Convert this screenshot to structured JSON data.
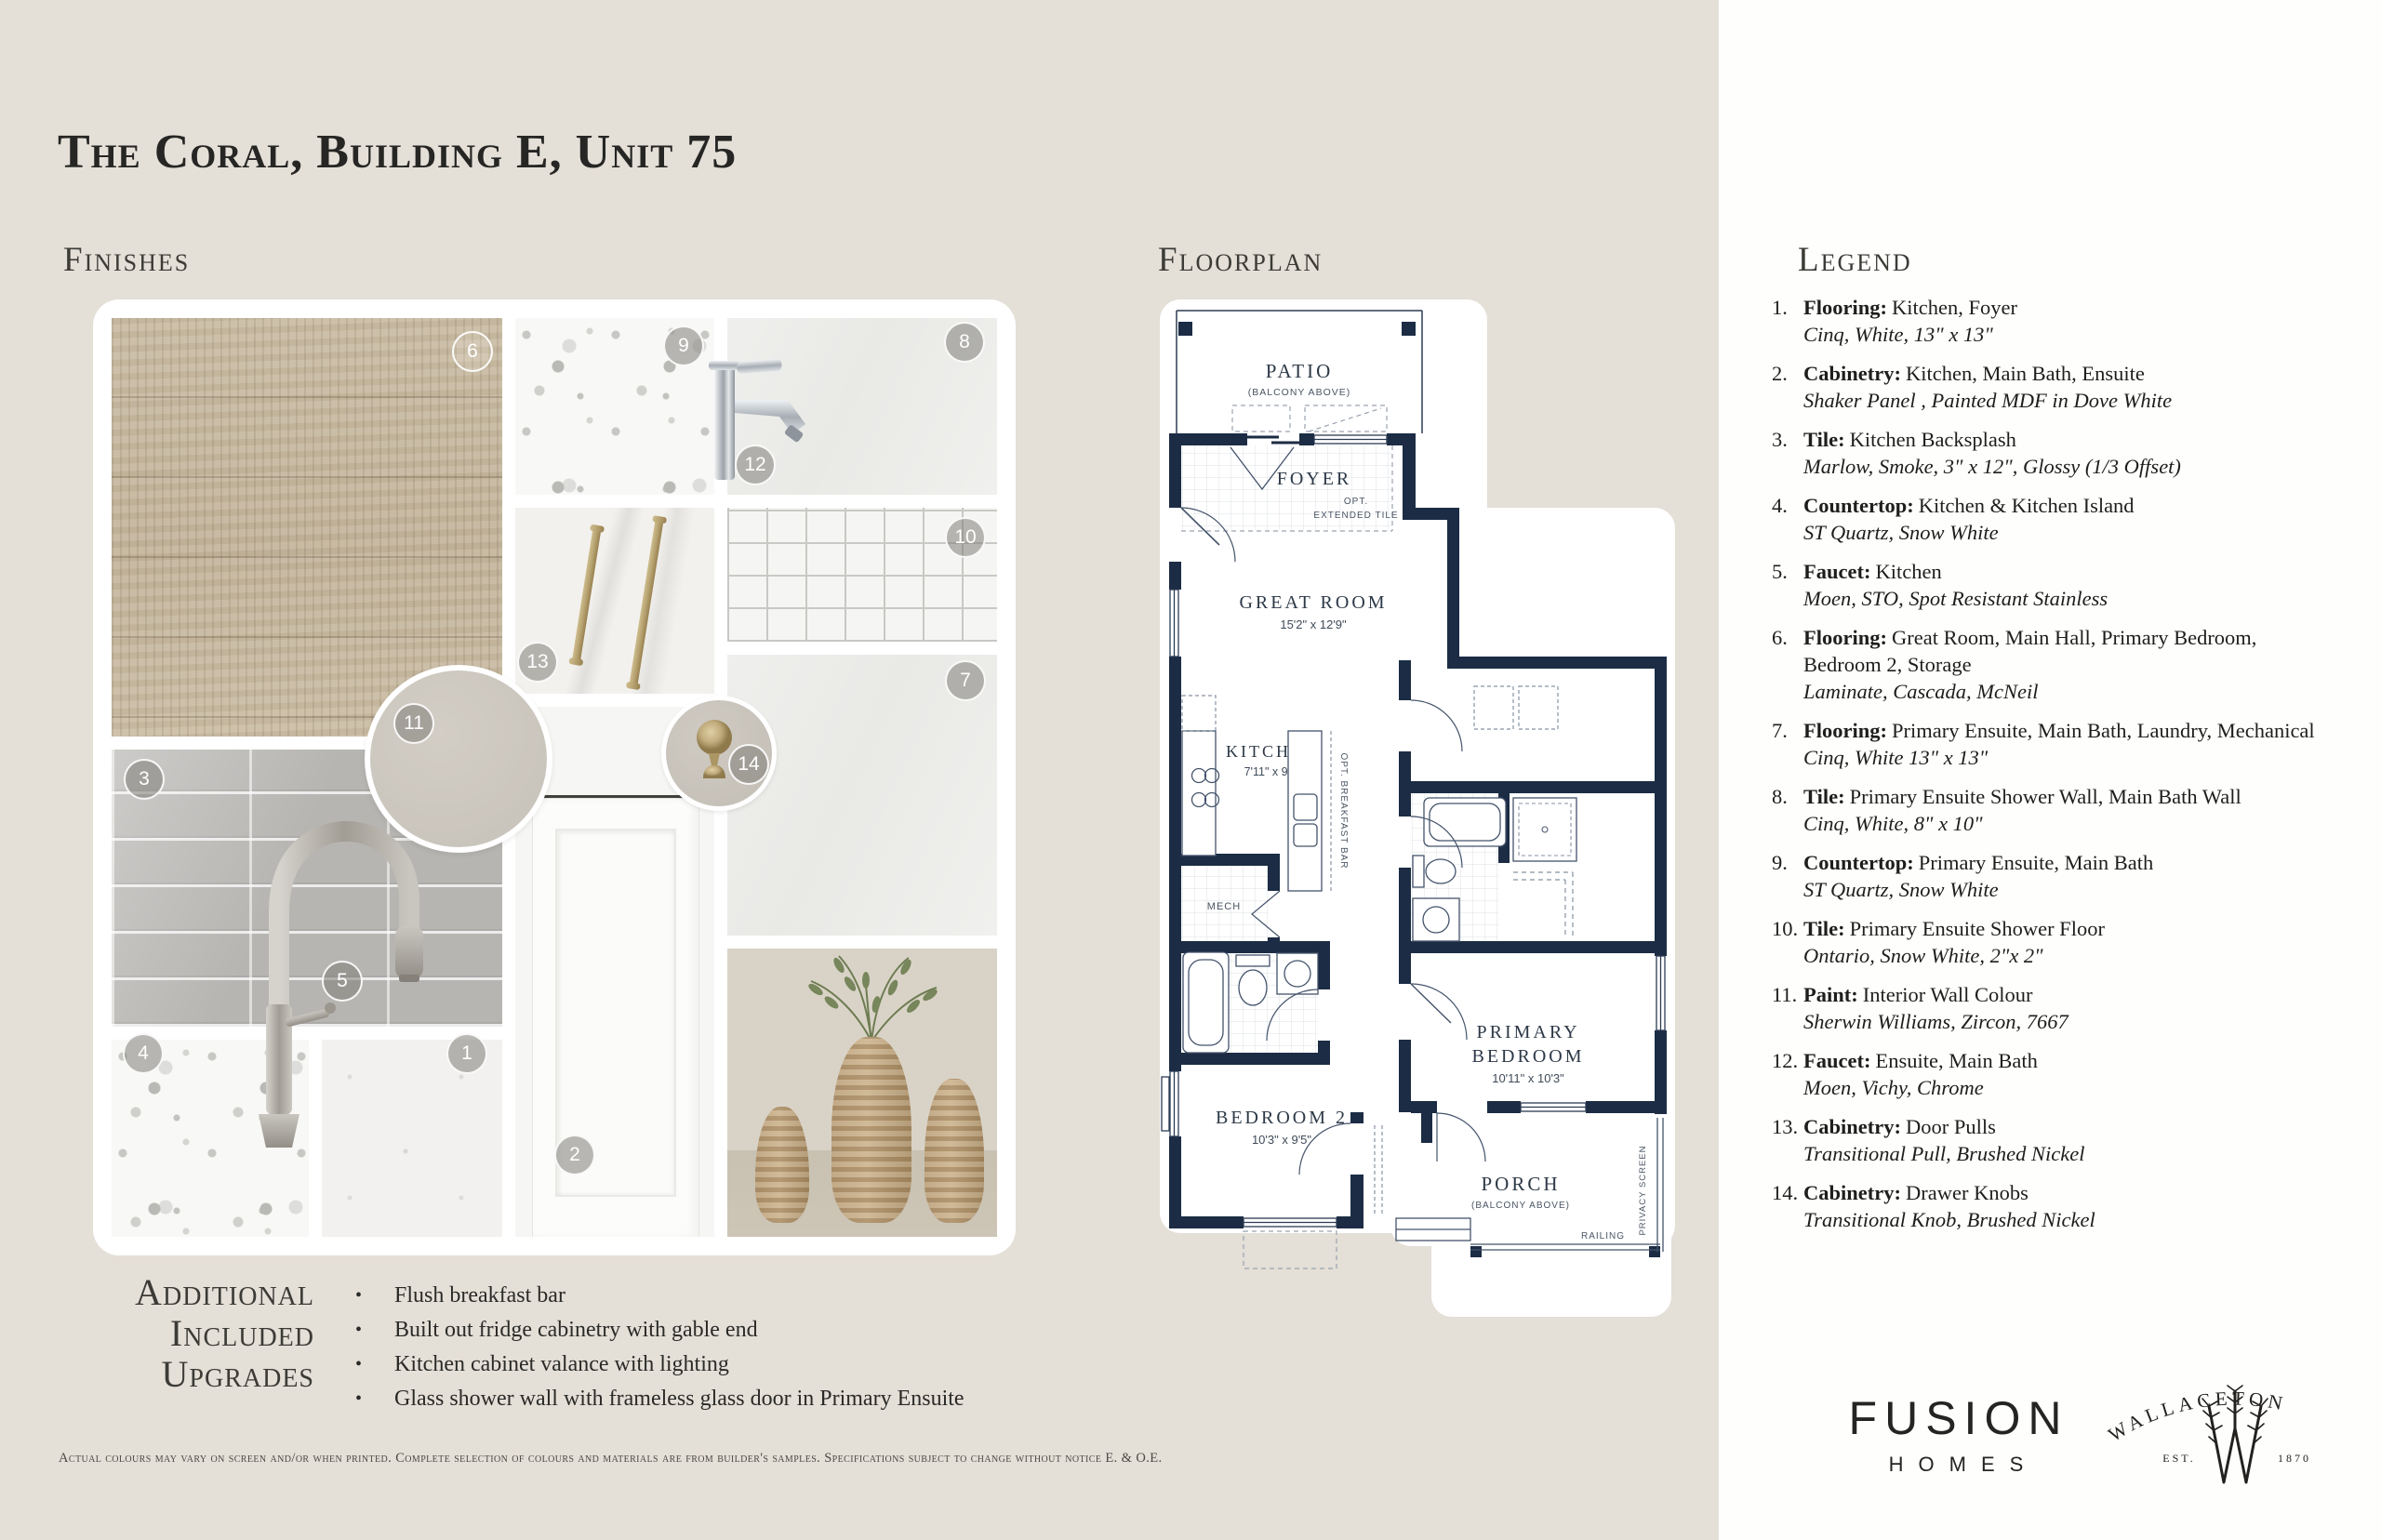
{
  "page": {
    "title": "The Coral, Building E, Unit 75"
  },
  "headings": {
    "finishes": "Finishes",
    "floorplan": "Floorplan",
    "legend": "Legend"
  },
  "finishes": {
    "badges": [
      "6",
      "9",
      "8",
      "12",
      "13",
      "10",
      "7",
      "11",
      "3",
      "5",
      "4",
      "1",
      "2",
      "14"
    ]
  },
  "floorplan": {
    "patio": "PATIO",
    "patio_sub": "(BALCONY ABOVE)",
    "foyer": "FOYER",
    "opt": "OPT.",
    "ext_tile": "EXTENDED TILE",
    "great_room": "GREAT ROOM",
    "great_room_dim": "15'2\" x 12'9\"",
    "kitchen": "KITCHEN",
    "kitchen_dim": "7'11\" x 9'3\"",
    "breakfast_bar": "OPT. BREAKFAST BAR",
    "mech": "MECH",
    "primary_1": "PRIMARY",
    "primary_2": "BEDROOM",
    "primary_dim": "10'11\" x 10'3\"",
    "bedroom2": "BEDROOM 2",
    "bedroom2_dim": "10'3\" x 9'5\"",
    "porch": "PORCH",
    "porch_sub": "(BALCONY ABOVE)",
    "privacy": "PRIVACY SCREEN",
    "railing": "RAILING"
  },
  "legend": {
    "items": [
      {
        "num": "1.",
        "label": "Flooring:",
        "text": "Kitchen, Foyer",
        "italic": "Cinq, White, 13\" x 13\""
      },
      {
        "num": "2.",
        "label": "Cabinetry:",
        "text": "Kitchen, Main Bath, Ensuite",
        "italic": "Shaker Panel , Painted MDF in Dove White"
      },
      {
        "num": "3.",
        "label": "Tile:",
        "text": "Kitchen Backsplash",
        "italic": "Marlow, Smoke, 3\" x 12\", Glossy (1/3 Offset)"
      },
      {
        "num": "4.",
        "label": "Countertop:",
        "text": "Kitchen & Kitchen Island",
        "italic": "ST Quartz, Snow White"
      },
      {
        "num": "5.",
        "label": "Faucet:",
        "text": "Kitchen",
        "italic": "Moen, STO, Spot Resistant Stainless"
      },
      {
        "num": "6.",
        "label": "Flooring:",
        "text": "Great Room, Main Hall, Primary Bedroom, Bedroom 2, Storage",
        "italic": "Laminate, Cascada, McNeil"
      },
      {
        "num": "7.",
        "label": "Flooring:",
        "text": "Primary Ensuite, Main Bath, Laundry, Mechanical",
        "italic": "Cinq, White 13\" x 13\""
      },
      {
        "num": "8.",
        "label": "Tile:",
        "text": "Primary Ensuite Shower Wall, Main Bath Wall",
        "italic": "Cinq, White, 8\" x 10\""
      },
      {
        "num": "9.",
        "label": "Countertop:",
        "text": "Primary Ensuite, Main Bath",
        "italic": "ST Quartz, Snow White"
      },
      {
        "num": "10.",
        "label": "Tile:",
        "text": "Primary Ensuite Shower Floor",
        "italic": "Ontario, Snow White, 2\"x 2\""
      },
      {
        "num": "11.",
        "label": "Paint:",
        "text": "Interior Wall Colour",
        "italic": "Sherwin Williams, Zircon, 7667"
      },
      {
        "num": "12.",
        "label": "Faucet:",
        "text": "Ensuite, Main Bath",
        "italic": "Moen, Vichy, Chrome"
      },
      {
        "num": "13.",
        "label": "Cabinetry:",
        "text": "Door Pulls",
        "italic": "Transitional Pull, Brushed Nickel"
      },
      {
        "num": "14.",
        "label": "Cabinetry:",
        "text": "Drawer Knobs",
        "italic": "Transitional Knob, Brushed Nickel"
      }
    ]
  },
  "upgrades": {
    "title": [
      "Additional",
      "Included",
      "Upgrades"
    ],
    "items": [
      "Flush breakfast bar",
      "Built out fridge cabinetry with gable end",
      "Kitchen cabinet valance with lighting",
      "Glass shower wall with frameless glass door in Primary Ensuite"
    ]
  },
  "disclaimer": "Actual colours may vary on screen and/or when printed.  Complete selection of colours and materials are from builder's samples. Specifications subject to change without notice E. & O.E.",
  "brand": {
    "fusion": "FUSION",
    "homes": "HOMES",
    "wallaceton": "WALLACETON",
    "est": "EST.",
    "year": "1870"
  }
}
